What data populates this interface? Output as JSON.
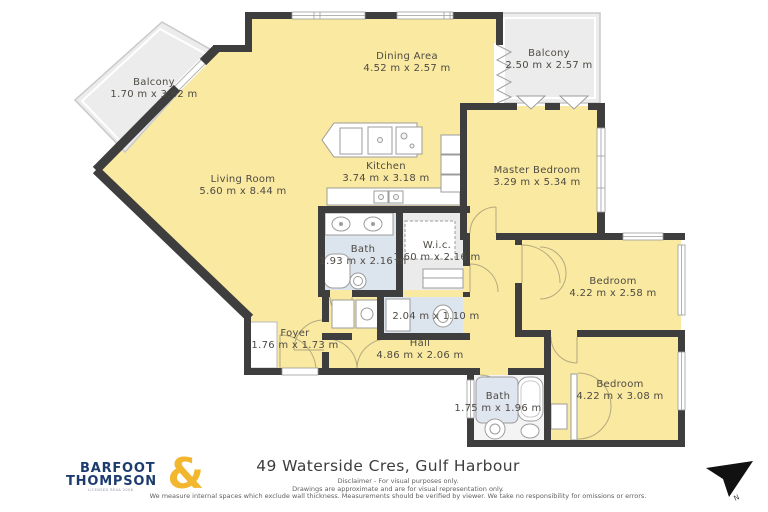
{
  "brand": {
    "line1": "BARFOOT",
    "line2": "THOMPSON",
    "ampersand": "&",
    "tagline": "LICENSED REAA 2008"
  },
  "address": "49 Waterside Cres, Gulf Harbour",
  "disclaimer": [
    "Disclaimer - For visual purposes only.",
    "Drawings are approximate and are for visual representation only.",
    "We measure internal spaces which exclude wall thickness. Measurements should be verified by viewer. We take no responsibility for omissions or errors."
  ],
  "north": {
    "label": "N"
  },
  "rooms": [
    {
      "id": "balcony-left",
      "name": "Balcony",
      "dims": "1.70 m x 3.62 m"
    },
    {
      "id": "dining",
      "name": "Dining Area",
      "dims": "4.52 m x 2.57 m"
    },
    {
      "id": "balcony-right",
      "name": "Balcony",
      "dims": "2.50 m x 2.57 m"
    },
    {
      "id": "living",
      "name": "Living Room",
      "dims": "5.60 m x 8.44 m"
    },
    {
      "id": "kitchen",
      "name": "Kitchen",
      "dims": "3.74 m x 3.18 m"
    },
    {
      "id": "master-bedroom",
      "name": "Master Bedroom",
      "dims": "3.29 m x 5.34 m"
    },
    {
      "id": "bath-ensuite",
      "name": "Bath",
      "dims": "1.93 m x 2.16 m"
    },
    {
      "id": "wic",
      "name": "W.i.c.",
      "dims": "1.60 m x 2.16 m"
    },
    {
      "id": "bedroom-mid",
      "name": "Bedroom",
      "dims": "4.22 m x 2.58 m"
    },
    {
      "id": "wc",
      "name": "",
      "dims": "2.04 m x 1.10 m"
    },
    {
      "id": "foyer",
      "name": "Foyer",
      "dims": "1.76 m x 1.73 m"
    },
    {
      "id": "hall",
      "name": "Hall",
      "dims": "4.86 m x 2.06 m"
    },
    {
      "id": "bath-main",
      "name": "Bath",
      "dims": "1.75 m x 1.96 m"
    },
    {
      "id": "bedroom-bottom",
      "name": "Bedroom",
      "dims": "4.22 m x 3.08 m"
    }
  ],
  "colors": {
    "wall": "#3e3e3e",
    "floor": "#fae9a1",
    "balcony": "#ececec",
    "wet_floor": "#dce4ee",
    "label_text": "#4e4a43",
    "brand_navy": "#1d3c6e",
    "brand_gold": "#f2b72e"
  }
}
